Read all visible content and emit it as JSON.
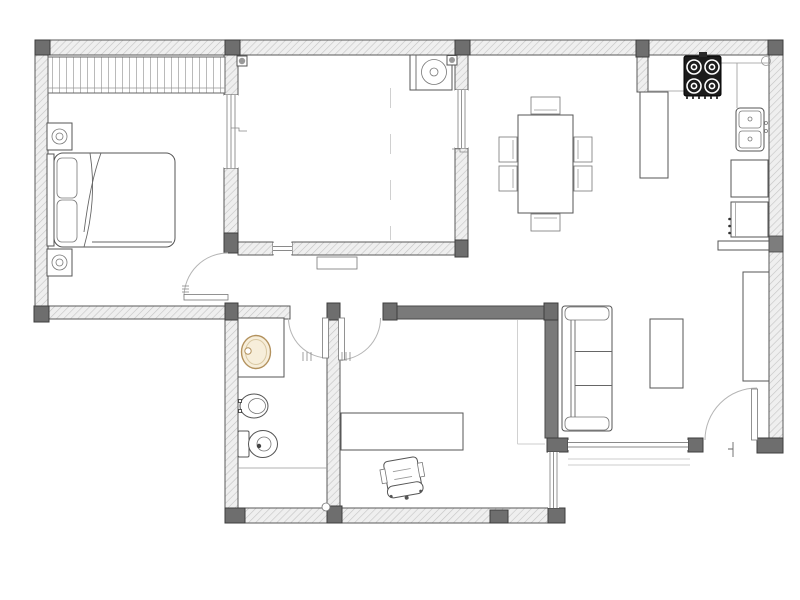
{
  "title": "Apartment floor plan",
  "type": "2d-floor-plan",
  "palette": {
    "background": "#ffffff",
    "wall_fill": "#efefef",
    "wall_hatch": "#c4c4c4",
    "wall_stroke": "#5a5a5a",
    "post": "#6e6e6e",
    "interior_dark_wall": "#7a7a7a",
    "drawing_line": "#555555",
    "door_arc": "#b5b5b5",
    "stove": "#1c1c1c",
    "fixture_accent": "#f7eeda",
    "fixture_accent_stroke": "#b3925e"
  },
  "rooms": [
    {
      "name": "bedroom",
      "furniture": [
        "wardrobe",
        "double-bed",
        "pillow x2",
        "nightstand-with-lamp x2"
      ]
    },
    {
      "name": "utility-room",
      "furniture": [
        "washing-machine",
        "ceiling-fixture x2",
        "sliding-partition-track"
      ]
    },
    {
      "name": "hallway",
      "furniture": [
        "doormat"
      ]
    },
    {
      "name": "bathroom",
      "furniture": [
        "washbasin-counter",
        "washbasin",
        "bidet",
        "toilet"
      ]
    },
    {
      "name": "study",
      "furniture": [
        "desk",
        "office-chair"
      ]
    },
    {
      "name": "living-dining-room",
      "furniture": [
        "dining-table",
        "dining-chair x6",
        "sofa-3-seat",
        "coffee-table",
        "tv-cabinet",
        "step-lines"
      ]
    },
    {
      "name": "kitchen",
      "furniture": [
        "cooktop-4-burner",
        "tall-cabinet",
        "double-sink",
        "base-cabinet x2",
        "peninsula-counter"
      ]
    }
  ],
  "doors": [
    {
      "name": "bedroom-door",
      "swings_into": "bedroom"
    },
    {
      "name": "bathroom-door",
      "swings_into": "bathroom"
    },
    {
      "name": "study-door",
      "swings_into": "study"
    },
    {
      "name": "entry-door",
      "swings_into": "living-dining-room"
    }
  ],
  "windows": [
    "utility-west-glazing",
    "utility-east-glazing",
    "utility-pass-through",
    "living-south-window",
    "study-east-window"
  ],
  "counts": {
    "rooms": 7,
    "doors": 4,
    "burners": 4,
    "dining_chairs": 6,
    "sofa_seats": 3
  }
}
